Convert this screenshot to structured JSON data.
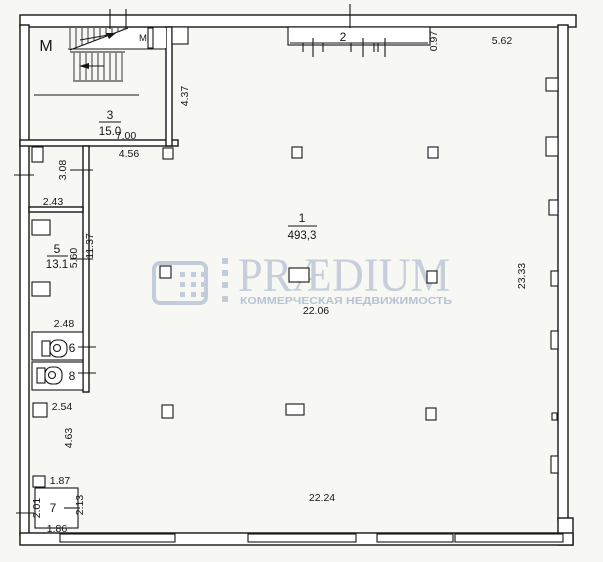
{
  "watermark": {
    "brand": "PRÆDIUM",
    "tagline": "КОММЕРЧЕСКАЯ НЕДВИЖИМОСТЬ",
    "color": "#c6cedb"
  },
  "rooms": {
    "r1": {
      "num": "1",
      "area": "493,3"
    },
    "r3": {
      "num": "3",
      "area": "15.0"
    },
    "r5": {
      "num": "5",
      "area": "13.1"
    },
    "r6": {
      "num": "6"
    },
    "r7": {
      "num": "7"
    },
    "r8": {
      "num": "8"
    },
    "zone2": {
      "num": "2"
    }
  },
  "stairs": {
    "m_large": "M",
    "m_small": "M"
  },
  "dims": {
    "w700": "7.00",
    "w456": "4.56",
    "h437": "4.37",
    "h308": "3.08",
    "w243": "2.43",
    "h560": "5.60",
    "h1137": "11.37",
    "w248": "2.48",
    "w254": "2.54",
    "h463": "4.63",
    "w187": "1.87",
    "h201": "2.01",
    "h213": "2.13",
    "w186": "1.86",
    "h097": "0.97",
    "w562": "5.62",
    "w2206": "22.06",
    "w2224": "22.24",
    "h2333": "23.33"
  }
}
